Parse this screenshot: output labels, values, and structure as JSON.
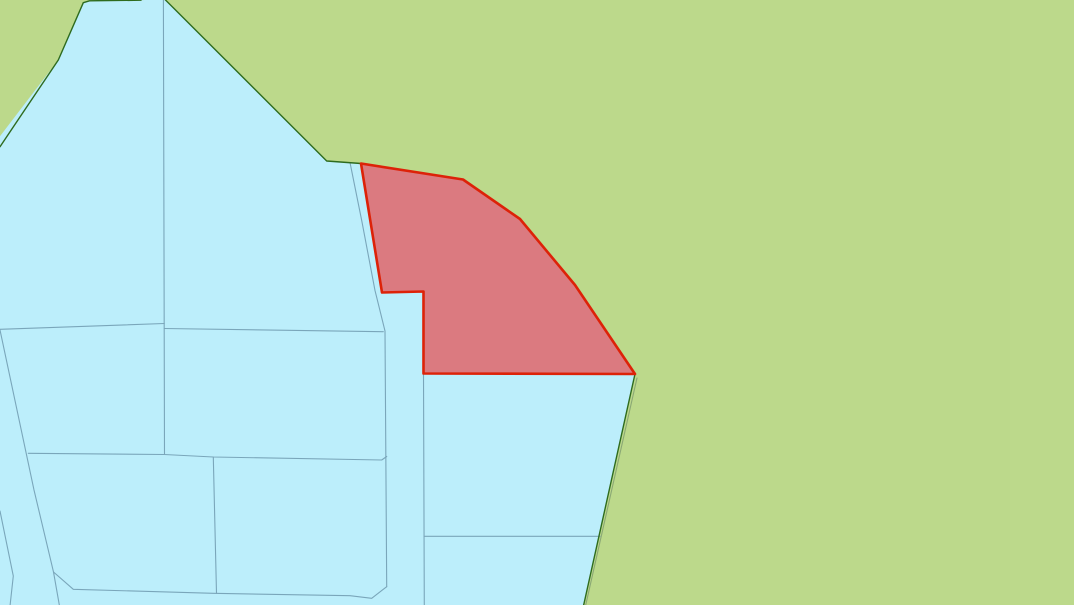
{
  "map": {
    "canvas": {
      "width": 1074,
      "height": 605
    },
    "colors": {
      "background": "#bcd98b",
      "parcel_fill": "#bceefb",
      "selection_fill": "#db7a80",
      "selection_stroke": "#dd2208",
      "boundary_green": "#2e6b1e",
      "parcel_line": "#7aa6ba",
      "secondary_line": "#8aa874"
    },
    "layers": [
      {
        "name": "background-land",
        "kind": "polygon",
        "fill": "background",
        "stroke": null,
        "stroke_width": 0,
        "interactable": true,
        "points": [
          [
            -2,
            -2
          ],
          [
            1076,
            -2
          ],
          [
            1076,
            607
          ],
          [
            -2,
            607
          ]
        ]
      },
      {
        "name": "blue-parcel-area",
        "kind": "polygon",
        "fill": "parcel_fill",
        "stroke": null,
        "stroke_width": 0,
        "interactable": true,
        "points": [
          [
            83.3,
            2.7
          ],
          [
            89.5,
            0.8
          ],
          [
            141,
            0.2
          ],
          [
            164.5,
            -1
          ],
          [
            326.7,
            161
          ],
          [
            361,
            163.5
          ],
          [
            463,
            179.5
          ],
          [
            520,
            219
          ],
          [
            575,
            285
          ],
          [
            635,
            374
          ],
          [
            583,
            608
          ],
          [
            -8,
            608
          ],
          [
            -8,
            146.7
          ],
          [
            58.3,
            60
          ]
        ]
      },
      {
        "name": "parcel-line-vertical-left",
        "kind": "polyline",
        "fill": null,
        "stroke": "parcel_line",
        "stroke_width": 1.1,
        "interactable": false,
        "points": [
          [
            163.4,
            -1
          ],
          [
            164.5,
            454.5
          ]
        ]
      },
      {
        "name": "parcel-line-horizontal-upper-left",
        "kind": "polyline",
        "fill": null,
        "stroke": "parcel_line",
        "stroke_width": 1.1,
        "interactable": false,
        "points": [
          [
            0,
            329.3
          ],
          [
            164.3,
            323.5
          ]
        ]
      },
      {
        "name": "parcel-line-horizontal-upper-right",
        "kind": "polyline",
        "fill": null,
        "stroke": "parcel_line",
        "stroke_width": 1.1,
        "interactable": false,
        "points": [
          [
            164.3,
            328.5
          ],
          [
            383.3,
            331.7
          ]
        ]
      },
      {
        "name": "parcel-line-diagonal-left",
        "kind": "polyline",
        "fill": null,
        "stroke": "parcel_line",
        "stroke_width": 1.1,
        "interactable": false,
        "points": [
          [
            0,
            330
          ],
          [
            34,
            490
          ],
          [
            53.5,
            572
          ],
          [
            59.5,
            606
          ]
        ]
      },
      {
        "name": "parcel-line-bottom-strip",
        "kind": "polyline",
        "fill": null,
        "stroke": "parcel_line",
        "stroke_width": 1.1,
        "interactable": false,
        "points": [
          [
            53.5,
            572
          ],
          [
            73.3,
            589.3
          ],
          [
            213.3,
            593.3
          ],
          [
            350,
            595.7
          ],
          [
            371.7,
            598.3
          ],
          [
            386.7,
            586.7
          ]
        ]
      },
      {
        "name": "parcel-line-road-west-edge",
        "kind": "polyline",
        "fill": null,
        "stroke": "parcel_line",
        "stroke_width": 1.1,
        "interactable": false,
        "points": [
          [
            350,
            162.5
          ],
          [
            362,
            222
          ],
          [
            375,
            290.5
          ],
          [
            385,
            331
          ],
          [
            386.7,
            586.7
          ]
        ]
      },
      {
        "name": "parcel-line-horizontal-mid",
        "kind": "polyline",
        "fill": null,
        "stroke": "parcel_line",
        "stroke_width": 1.1,
        "interactable": false,
        "points": [
          [
            28.3,
            453.3
          ],
          [
            164.3,
            454.5
          ],
          [
            213.3,
            457
          ],
          [
            381.7,
            460
          ],
          [
            386.7,
            456.5
          ]
        ]
      },
      {
        "name": "parcel-line-vertical-mid",
        "kind": "polyline",
        "fill": null,
        "stroke": "parcel_line",
        "stroke_width": 1.1,
        "interactable": false,
        "points": [
          [
            213.3,
            457
          ],
          [
            216.5,
            593.3
          ]
        ]
      },
      {
        "name": "parcel-line-road-east-edge",
        "kind": "polyline",
        "fill": null,
        "stroke": "parcel_line",
        "stroke_width": 1.1,
        "interactable": false,
        "points": [
          [
            423.5,
            373.5
          ],
          [
            424.3,
            606
          ]
        ]
      },
      {
        "name": "parcel-line-horizontal-lower-right",
        "kind": "polyline",
        "fill": null,
        "stroke": "parcel_line",
        "stroke_width": 1.1,
        "interactable": false,
        "points": [
          [
            424,
            536.3
          ],
          [
            600,
            536.3
          ]
        ]
      },
      {
        "name": "parcel-line-bottom-left-diagonal",
        "kind": "polyline",
        "fill": null,
        "stroke": "parcel_line",
        "stroke_width": 1.1,
        "interactable": false,
        "points": [
          [
            0,
            511
          ],
          [
            13.3,
            576
          ],
          [
            10,
            606
          ]
        ]
      },
      {
        "name": "secondary-line-southeast",
        "kind": "polyline",
        "fill": null,
        "stroke": "secondary_line",
        "stroke_width": 1.1,
        "interactable": false,
        "points": [
          [
            637,
            378
          ],
          [
            585.5,
            606
          ]
        ]
      },
      {
        "name": "boundary-left-wedge",
        "kind": "polyline",
        "fill": null,
        "stroke": "boundary_green",
        "stroke_width": 1.4,
        "interactable": false,
        "points": [
          [
            0,
            146.7
          ],
          [
            58.3,
            60
          ],
          [
            83.3,
            2.7
          ],
          [
            89.5,
            0.8
          ],
          [
            141,
            0.2
          ]
        ]
      },
      {
        "name": "boundary-northeast-diagonal",
        "kind": "polyline",
        "fill": null,
        "stroke": "boundary_green",
        "stroke_width": 1.4,
        "interactable": false,
        "points": [
          [
            164.5,
            -1
          ],
          [
            326.7,
            161
          ],
          [
            361,
            163.5
          ]
        ]
      },
      {
        "name": "boundary-southeast-diagonal",
        "kind": "polyline",
        "fill": null,
        "stroke": "boundary_green",
        "stroke_width": 1.4,
        "interactable": false,
        "points": [
          [
            635,
            374
          ],
          [
            583,
            608
          ]
        ]
      },
      {
        "name": "selected-parcel",
        "kind": "polygon",
        "fill": "selection_fill",
        "stroke": "selection_stroke",
        "stroke_width": 2.6,
        "interactable": true,
        "points": [
          [
            361,
            163.5
          ],
          [
            463,
            179.5
          ],
          [
            520,
            219
          ],
          [
            575,
            285
          ],
          [
            635,
            374
          ],
          [
            423.5,
            373.5
          ],
          [
            423.5,
            291.5
          ],
          [
            382,
            292.5
          ]
        ]
      }
    ]
  }
}
